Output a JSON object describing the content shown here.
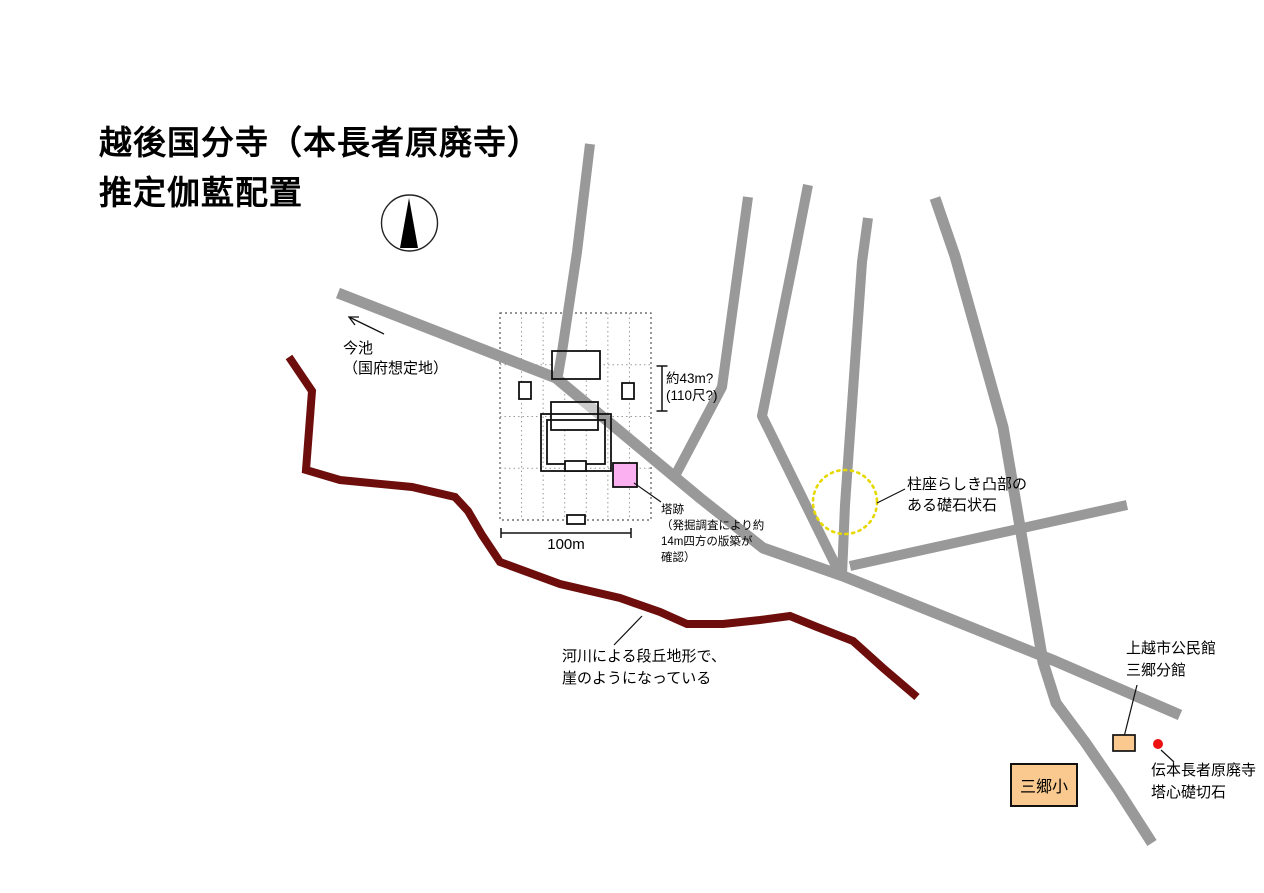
{
  "title": "越後国分寺（本長者原廃寺）\n推定伽藍配置",
  "annotations": {
    "imaike": "今池\n（国府想定地）",
    "dimension": "約43m?\n(110尺?)",
    "scale": "100m",
    "pagoda_site": "塔跡\n（発掘調査により約\n14m四方の版築が\n確認）",
    "foundation_stone": "柱座らしき凸部の\nある礎石状石",
    "cliff": "河川による段丘地形で、\n崖のようになっている",
    "community_hall": "上越市公民館\n三郷分館",
    "center_stone": "伝本長者原廃寺\n塔心礎切石",
    "school": "三郷小"
  },
  "colors": {
    "road": "#999999",
    "cliff": "#6d0e0c",
    "grid_outer": "#555555",
    "grid_inner": "#9a9a9a",
    "outline": "#111111",
    "pagoda_pink": "#fbb0f1",
    "orange": "#f9c98f",
    "yellow_circle": "#e6d800",
    "red_dot": "#ee1111",
    "ink": "#000000"
  },
  "map": {
    "roads": [
      {
        "name": "road-north-1",
        "width": 10,
        "points": [
          [
            590,
            144
          ],
          [
            577,
            252
          ],
          [
            562,
            352
          ],
          [
            557,
            381
          ]
        ]
      },
      {
        "name": "road-north-2",
        "width": 10,
        "points": [
          [
            748,
            197
          ],
          [
            722,
            387
          ],
          [
            676,
            474
          ]
        ]
      },
      {
        "name": "road-north-3",
        "width": 10,
        "points": [
          [
            808,
            185
          ],
          [
            794,
            257
          ],
          [
            762,
            416
          ],
          [
            838,
            570
          ]
        ]
      },
      {
        "name": "road-north-4",
        "width": 10,
        "points": [
          [
            868,
            218
          ],
          [
            862,
            262
          ],
          [
            845,
            505
          ],
          [
            842,
            575
          ]
        ]
      },
      {
        "name": "road-north-5",
        "width": 11,
        "points": [
          [
            935,
            198
          ],
          [
            955,
            256
          ],
          [
            1003,
            427
          ],
          [
            1043,
            662
          ],
          [
            1056,
            703
          ],
          [
            1085,
            742
          ],
          [
            1118,
            790
          ],
          [
            1152,
            843
          ]
        ]
      },
      {
        "name": "road-main-diagonal",
        "width": 11,
        "points": [
          [
            338,
            293
          ],
          [
            556,
            378
          ],
          [
            700,
            498
          ],
          [
            763,
            548
          ],
          [
            843,
            576
          ],
          [
            1055,
            661
          ],
          [
            1180,
            715
          ]
        ]
      },
      {
        "name": "road-branch-east",
        "width": 10,
        "points": [
          [
            850,
            566
          ],
          [
            1127,
            505
          ]
        ]
      }
    ],
    "cliff_line": {
      "name": "cliff-terrace-edge",
      "width": 8,
      "points": [
        [
          289,
          357
        ],
        [
          312,
          391
        ],
        [
          306,
          470
        ],
        [
          340,
          480
        ],
        [
          412,
          487
        ],
        [
          455,
          497
        ],
        [
          468,
          511
        ],
        [
          482,
          535
        ],
        [
          500,
          562
        ],
        [
          560,
          584
        ],
        [
          620,
          598
        ],
        [
          660,
          612
        ],
        [
          687,
          624
        ],
        [
          723,
          624
        ],
        [
          760,
          620
        ],
        [
          790,
          616
        ],
        [
          817,
          627
        ],
        [
          853,
          641
        ],
        [
          883,
          668
        ],
        [
          917,
          697
        ]
      ]
    },
    "precinct_grid": {
      "x": 500,
      "y": 313,
      "w": 151,
      "h": 207,
      "cols": 7,
      "rows": 4
    },
    "buildings": [
      {
        "name": "hall-north",
        "x": 552,
        "y": 351,
        "w": 48,
        "h": 28,
        "fill": "white"
      },
      {
        "name": "side-building-west",
        "x": 519,
        "y": 382,
        "w": 12,
        "h": 17,
        "fill": "white"
      },
      {
        "name": "side-building-east",
        "x": 622,
        "y": 383,
        "w": 12,
        "h": 16,
        "fill": "white"
      },
      {
        "name": "hall-main",
        "x": 551,
        "y": 402,
        "w": 47,
        "h": 28,
        "fill": "white",
        "overlay": true
      },
      {
        "name": "corridor-outer",
        "x": 541,
        "y": 414,
        "w": 70,
        "h": 57,
        "fill": "none"
      },
      {
        "name": "corridor-inner",
        "x": 547,
        "y": 420,
        "w": 58,
        "h": 44,
        "fill": "none"
      },
      {
        "name": "gate-middle",
        "x": 565,
        "y": 461,
        "w": 21,
        "h": 10,
        "fill": "white",
        "top": true
      },
      {
        "name": "gate-south",
        "x": 567,
        "y": 515,
        "w": 18,
        "h": 9,
        "fill": "white",
        "top": true
      },
      {
        "name": "pagoda-site-square",
        "x": 613,
        "y": 463,
        "w": 24,
        "h": 24,
        "fill": "pink",
        "top": true
      }
    ],
    "stone_circle": {
      "cx": 845,
      "cy": 502,
      "r": 32
    },
    "red_marker": {
      "cx": 1158,
      "cy": 744,
      "r": 5
    },
    "hall_building": {
      "x": 1113,
      "y": 735,
      "w": 22,
      "h": 16
    },
    "compass": {
      "cx": 409.5,
      "cy": 223,
      "r": 28,
      "needle": [
        [
          409,
          198
        ],
        [
          400,
          248
        ],
        [
          418,
          248
        ]
      ]
    },
    "scale_bar": {
      "x1": 501,
      "x2": 631,
      "y": 533,
      "tick": 5
    },
    "dimension_bracket": {
      "x": 662,
      "y1": 366,
      "y2": 411,
      "cap": 5.5
    },
    "leader_lines": [
      {
        "name": "leader-pagoda-site",
        "points": [
          [
            634,
            483
          ],
          [
            661,
            502
          ]
        ]
      },
      {
        "name": "leader-foundation-stone",
        "points": [
          [
            877,
            503
          ],
          [
            905,
            489
          ]
        ]
      },
      {
        "name": "leader-cliff",
        "points": [
          [
            642,
            616
          ],
          [
            614,
            645
          ]
        ]
      },
      {
        "name": "leader-community-hall",
        "points": [
          [
            1137,
            685
          ],
          [
            1124,
            737
          ]
        ]
      },
      {
        "name": "leader-center-stone",
        "points": [
          [
            1161,
            750
          ],
          [
            1174,
            762
          ]
        ]
      }
    ],
    "imaike_arrow": {
      "line": [
        [
          384,
          334
        ],
        [
          349,
          317
        ]
      ],
      "head": [
        [
          355,
          325
        ],
        [
          349,
          317
        ],
        [
          359,
          317
        ]
      ]
    }
  }
}
